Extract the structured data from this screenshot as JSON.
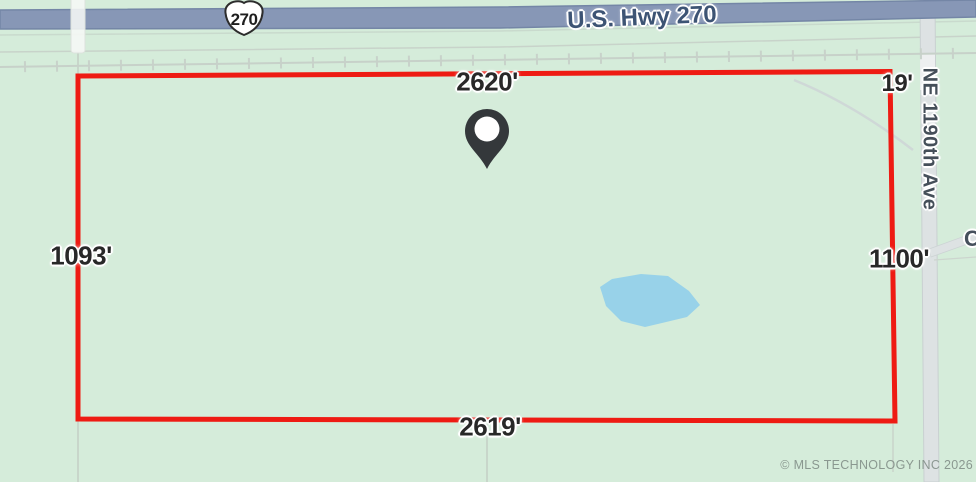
{
  "map": {
    "roads": {
      "highway_label": "U.S. Hwy 270",
      "highway_shield": "270",
      "cross_street_label": "NE 1190th Ave",
      "partial_road_label": "C"
    },
    "parcel": {
      "top_dimension": "2620'",
      "bottom_dimension": "2619'",
      "left_dimension": "1093'",
      "right_dimension": "1100'",
      "corner_dimension": "19'"
    },
    "attribution": "© MLS TECHNOLOGY INC 2026",
    "colors": {
      "boundary": "#ee1b13",
      "highway_fill": "#8797b6",
      "highway_edge": "#7486a6",
      "pond_fill": "#98d2e9",
      "land_fill": "#d5ecda",
      "pin_fill": "#34383b"
    }
  }
}
